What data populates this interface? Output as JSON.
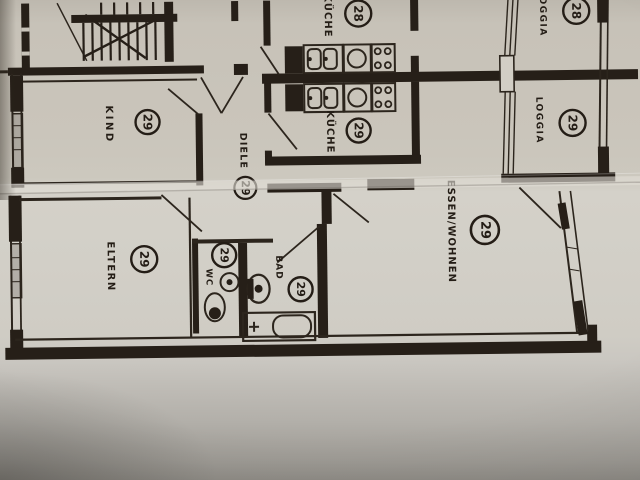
{
  "plan": {
    "colors": {
      "ink": "#261f18",
      "paper": "#cdc9c1",
      "paper_shadow": "#8f8c86",
      "crease": "#ded8cf"
    },
    "rooms": [
      {
        "key": "kueche-28",
        "label": "KÜCHE",
        "unit": "28"
      },
      {
        "key": "loggia-28",
        "label": "LOGGIA",
        "unit": "28"
      },
      {
        "key": "kind",
        "label": "KIND",
        "unit": "29"
      },
      {
        "key": "kueche-29",
        "label": "KÜCHE",
        "unit": "29"
      },
      {
        "key": "loggia-29",
        "label": "LOGGIA",
        "unit": "29"
      },
      {
        "key": "diele",
        "label": "DIELE",
        "unit": "29"
      },
      {
        "key": "eltern",
        "label": "ELTERN",
        "unit": "29"
      },
      {
        "key": "wc",
        "label": "WC",
        "unit": "29"
      },
      {
        "key": "bad",
        "label": "BAD",
        "unit": "29"
      },
      {
        "key": "essen-wohnen",
        "label": "ESSEN/WOHNEN",
        "unit": "29"
      }
    ],
    "icons": {
      "stairs": "hatched bars with zigzag run-line",
      "fridge": "solid black block",
      "kitchen_sink": "double basin rounded squares",
      "hob": "single ring",
      "stove": "four burner rings",
      "toilet": "oval bowl",
      "washbasin": "round basin with dot",
      "bathtub": "rectangle with rounded inner tub and tap cross",
      "window": "double line with hatching",
      "door": "swing diagonal"
    }
  }
}
